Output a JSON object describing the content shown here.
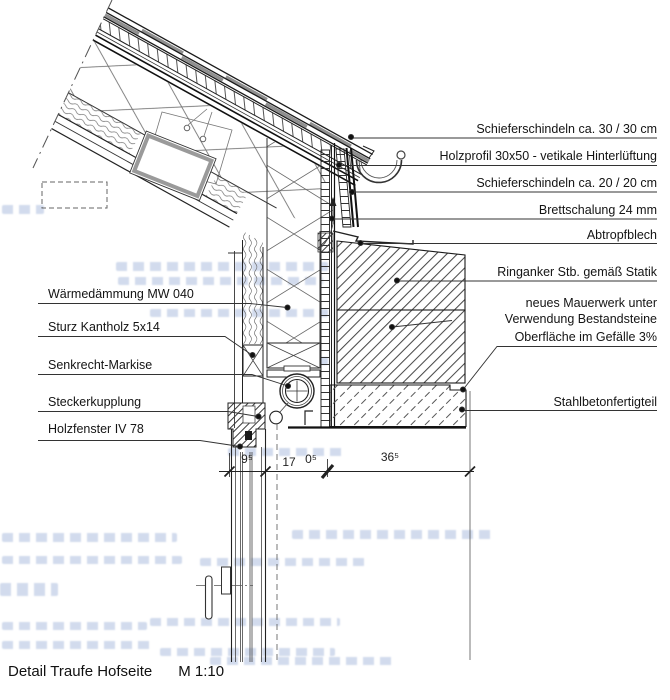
{
  "title": {
    "text": "Detail Traufe Hofseite",
    "scale": "M 1:10"
  },
  "labels": {
    "right": [
      "Schieferschindeln ca. 30 / 30 cm",
      "Holzprofil 30x50 - vetikale Hinterlüftung",
      "Schieferschindeln ca. 20 / 20 cm",
      "Brettschalung 24 mm",
      "Abtropfblech",
      "Ringanker Stb. gemäß Statik",
      "neues Mauerwerk unter",
      "Verwendung Bestandsteine",
      "Oberfläche im Gefälle 3%",
      "Stahlbetonfertigteil"
    ],
    "left": [
      "Wärmedämmung MW 040",
      "Sturz Kantholz 5x14",
      "Senkrecht-Markise",
      "Steckerkupplung",
      "Holzfenster IV 78"
    ]
  },
  "dimensions": {
    "segments": [
      "9⁵",
      "17",
      "0⁵",
      "36⁵"
    ]
  },
  "colors": {
    "line": "#1a1a1a",
    "shingle_gray": "#8f8f8f",
    "skylight_frame": "#9a9a9a",
    "bleed_through_blue": "#6f8cc3",
    "background": "#ffffff"
  }
}
